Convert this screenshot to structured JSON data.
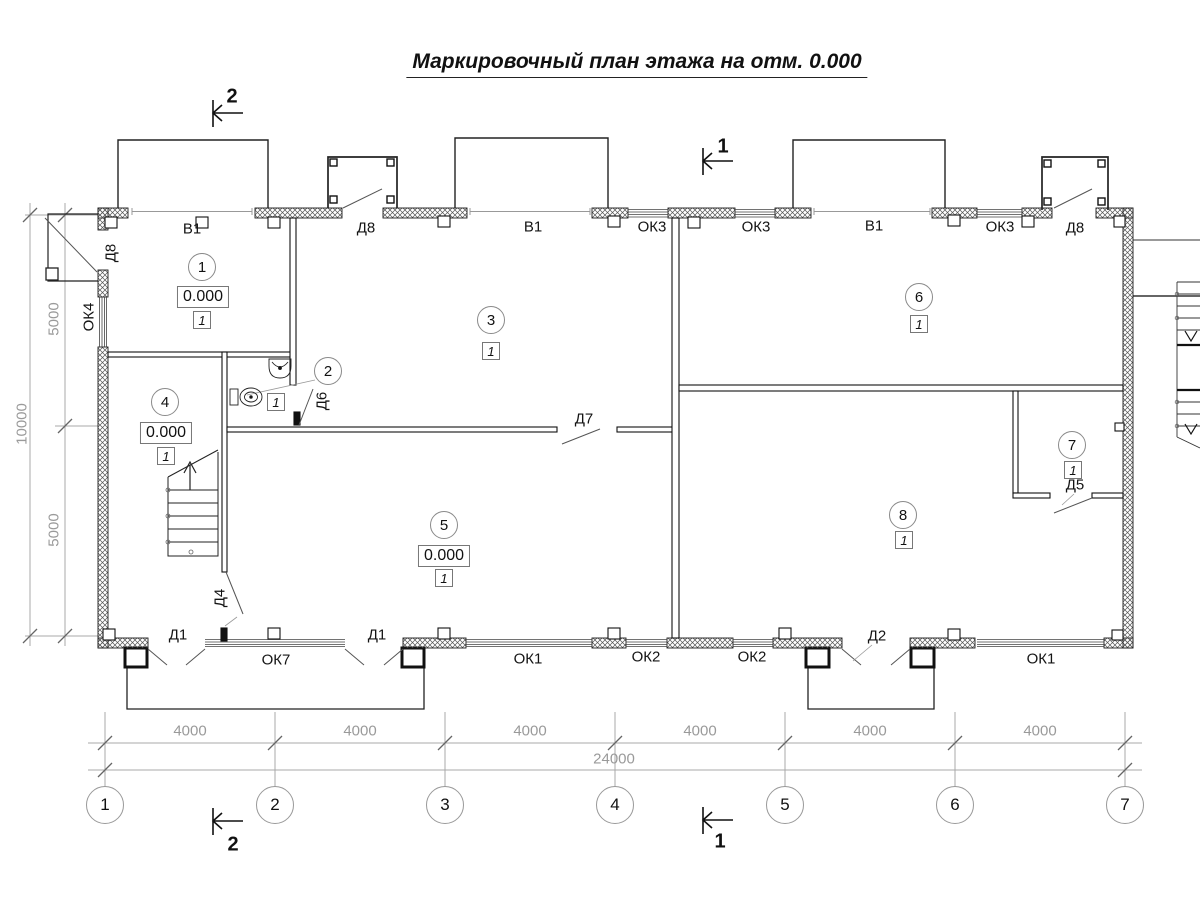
{
  "title": "Маркировочный план этажа на отм. 0.000",
  "marks": {
    "d8_left": "Д8",
    "v1_a": "В1",
    "d8_top_a": "Д8",
    "v1_b": "В1",
    "ok3_a": "ОК3",
    "ok3_b": "ОК3",
    "v1_c": "В1",
    "ok3_c": "ОК3",
    "d8_top_b": "Д8",
    "ok4": "ОК4",
    "d6": "Д6",
    "d7": "Д7",
    "d5": "Д5",
    "d4": "Д4",
    "d1_a": "Д1",
    "ok7": "ОК7",
    "d1_b": "Д1",
    "ok1_a": "ОК1",
    "ok2_a": "ОК2",
    "ok2_b": "ОК2",
    "d2": "Д2",
    "ok1_b": "ОК1"
  },
  "rooms": [
    {
      "num": "1",
      "elev": "0.000",
      "type": "1"
    },
    {
      "num": "2",
      "type": "1"
    },
    {
      "num": "3",
      "type": "1"
    },
    {
      "num": "4",
      "elev": "0.000",
      "type": "1"
    },
    {
      "num": "5",
      "elev": "0.000",
      "type": "1"
    },
    {
      "num": "6",
      "type": "1"
    },
    {
      "num": "7",
      "type": "1"
    },
    {
      "num": "8",
      "type": "1"
    }
  ],
  "grid_axes": [
    "1",
    "2",
    "3",
    "4",
    "5",
    "6",
    "7"
  ],
  "dimensions": {
    "spans": [
      "4000",
      "4000",
      "4000",
      "4000",
      "4000",
      "4000"
    ],
    "total": "24000",
    "left_upper": "5000",
    "left_lower": "5000",
    "left_total": "10000"
  },
  "sections": {
    "s1": "1",
    "s2": "2"
  }
}
